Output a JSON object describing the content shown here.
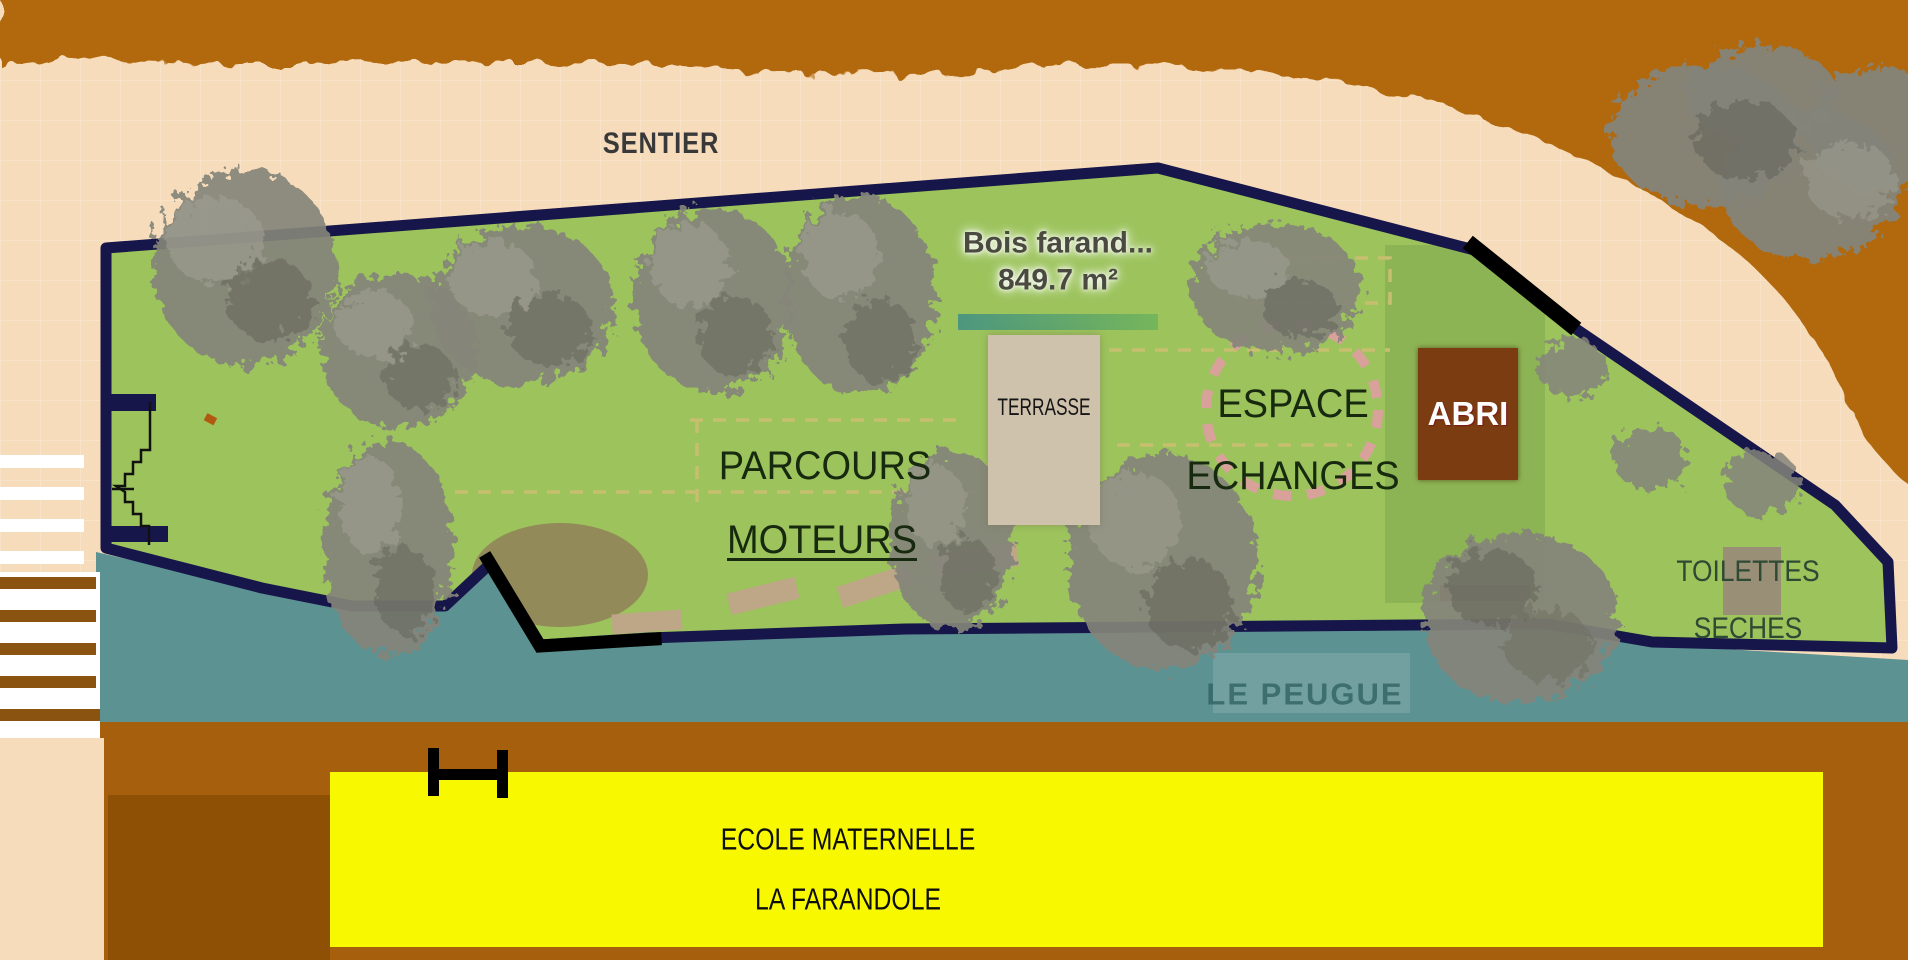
{
  "map": {
    "labels": {
      "sentier": "SENTIER",
      "bois_name": "Bois farand...",
      "bois_area": "849.7 m²",
      "terrasse": "TERRASSE",
      "espace_line1": "ESPACE",
      "espace_line2": "ECHANGES",
      "abri": "ABRI",
      "parcours_line1": "PARCOURS",
      "parcours_line2": "MOTEURS",
      "toilettes_line1": "TOILETTES",
      "toilettes_line2": "SECHES",
      "stream": "LE PEUGUE",
      "school_line1": "ECOLE MATERNELLE",
      "school_line2": "LA FARANDOLE"
    },
    "colors": {
      "grass_green": "#9cc35c",
      "flat_green": "#8db454",
      "path_cream": "#f7dcbb",
      "earth_orange": "#b2690e",
      "water_teal": "#5d9292",
      "boundary_navy": "#16164a",
      "banner_yellow": "#f8f800",
      "band_brown": "#a55f0d",
      "abri_brown": "#7a3c10",
      "terrasse_beige": "#cfc2ad",
      "toilettes_grey": "#998b7a",
      "tree_grey": "#84847a"
    }
  }
}
